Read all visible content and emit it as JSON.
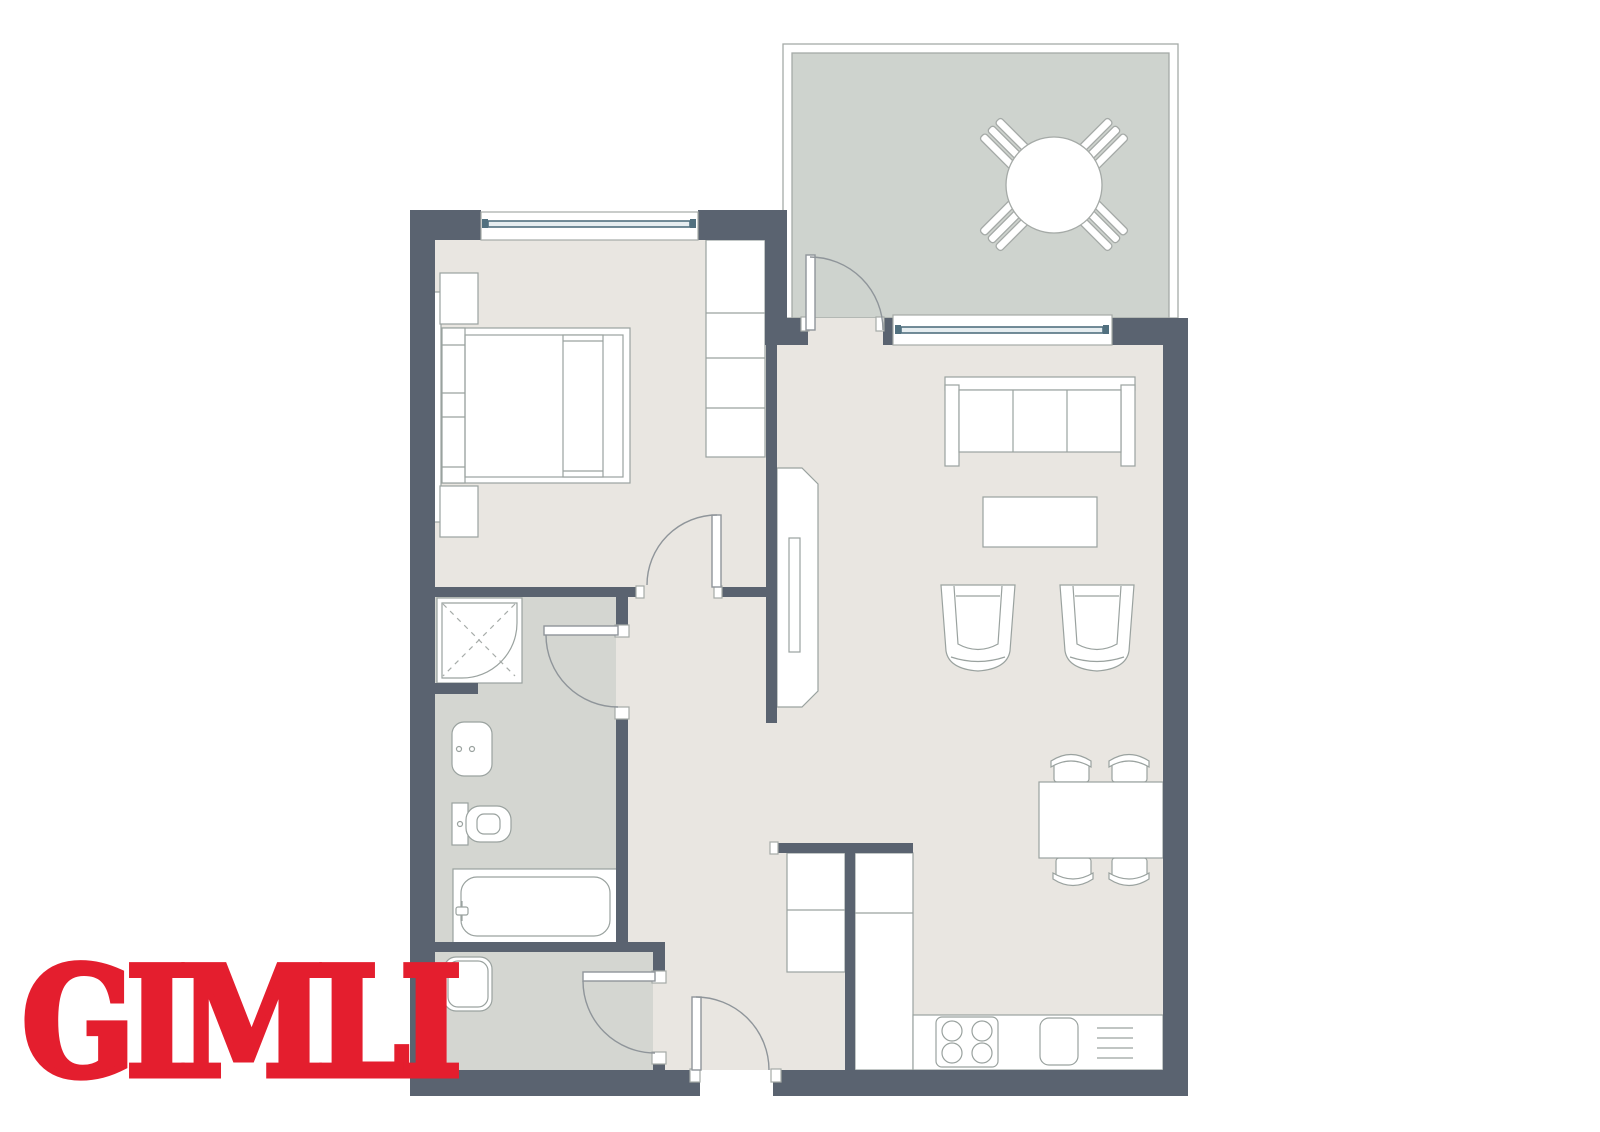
{
  "logo": {
    "text": "GIMLI",
    "color": "#e41e2e"
  },
  "colors": {
    "background": "#ffffff",
    "wall": "#5a6370",
    "floor_main": "#e9e6e1",
    "floor_wet": "#d4d6d1",
    "floor_balcony": "#ced3ce",
    "balcony_outline": "#a5aaa7",
    "furniture_stroke": "#9aa29f",
    "furniture_fill": "#ffffff",
    "door_stroke": "#8f959a",
    "glazing": "#51707f",
    "glazing_fill": "#e6edf0",
    "shower_dash": "#a7aca9"
  },
  "elements": {
    "balcony": [
      "round-table",
      "patio-chair x4"
    ],
    "bedroom": [
      "double-bed",
      "nightstand x2",
      "wardrobe",
      "window"
    ],
    "bathroom": [
      "shower",
      "washbasin",
      "toilet",
      "bathtub"
    ],
    "utility_room": [
      "washbasin"
    ],
    "living_room": [
      "sofa",
      "coffee-table",
      "armchair x2",
      "tv-unit",
      "window"
    ],
    "dining": [
      "dining-table",
      "dining-chair x4"
    ],
    "kitchen": [
      "tall-cabinet",
      "counter-column",
      "counter-run",
      "cooktop",
      "sink",
      "dishwasher"
    ],
    "doors": [
      "bedroom-door",
      "bathroom-door",
      "utility-door",
      "entry-door",
      "balcony-door"
    ]
  }
}
